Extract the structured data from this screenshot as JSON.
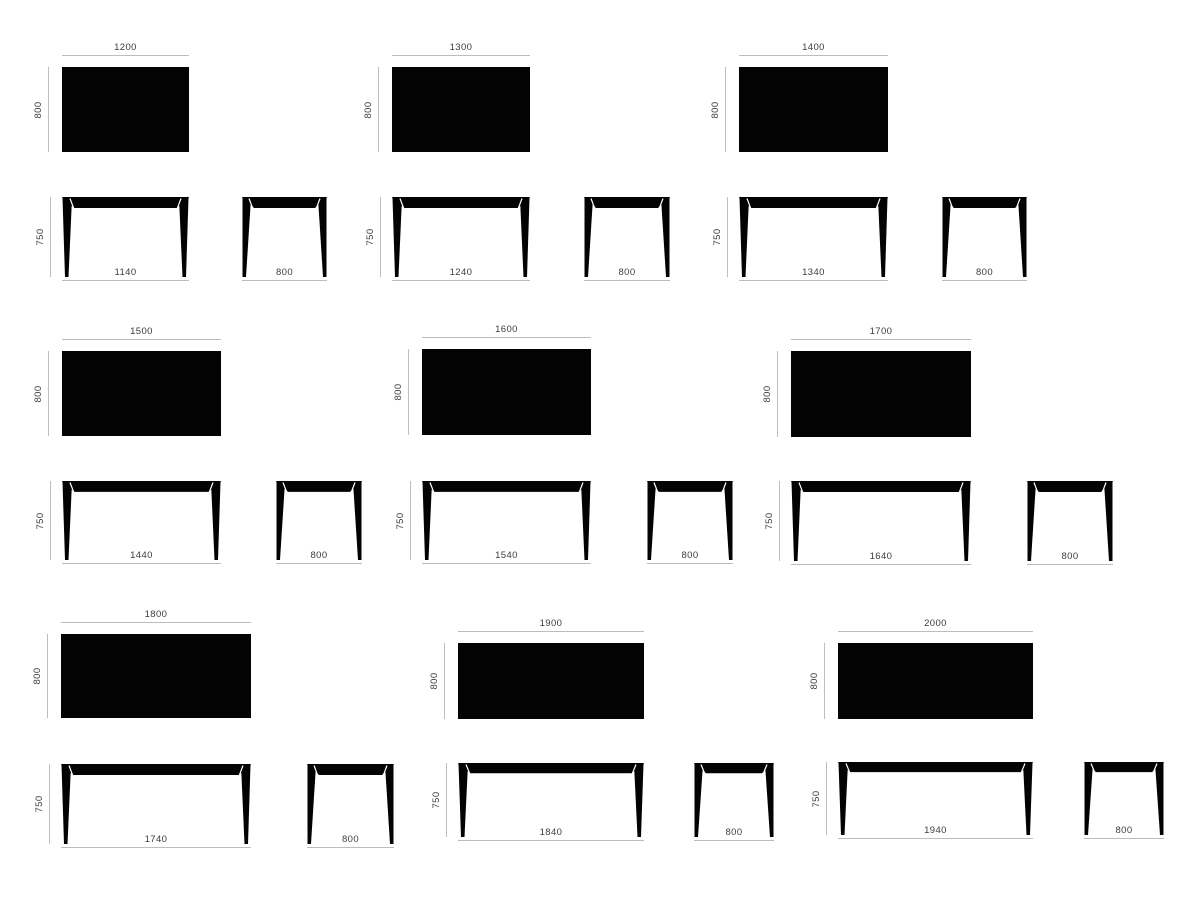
{
  "drawing": {
    "kind": "table-size-variants-technical-drawing",
    "colors": {
      "shape": "#030303",
      "dim_line": "#bdbdbd",
      "dim_text": "#3c3c3c",
      "background": "#ffffff"
    },
    "cells": [
      {
        "name": "1200",
        "top_width": "1200",
        "depth": "800",
        "height": "750",
        "feet_span": "1140",
        "side_span": "800"
      },
      {
        "name": "1300",
        "top_width": "1300",
        "depth": "800",
        "height": "750",
        "feet_span": "1240",
        "side_span": "800"
      },
      {
        "name": "1400",
        "top_width": "1400",
        "depth": "800",
        "height": "750",
        "feet_span": "1340",
        "side_span": "800"
      },
      {
        "name": "1500",
        "top_width": "1500",
        "depth": "800",
        "height": "750",
        "feet_span": "1440",
        "side_span": "800"
      },
      {
        "name": "1600",
        "top_width": "1600",
        "depth": "800",
        "height": "750",
        "feet_span": "1540",
        "side_span": "800"
      },
      {
        "name": "1700",
        "top_width": "1700",
        "depth": "800",
        "height": "750",
        "feet_span": "1640",
        "side_span": "800"
      },
      {
        "name": "1800",
        "top_width": "1800",
        "depth": "800",
        "height": "750",
        "feet_span": "1740",
        "side_span": "800"
      },
      {
        "name": "1900",
        "top_width": "1900",
        "depth": "800",
        "height": "750",
        "feet_span": "1840",
        "side_span": "800"
      },
      {
        "name": "2000",
        "top_width": "2000",
        "depth": "800",
        "height": "750",
        "feet_span": "1940",
        "side_span": "800"
      }
    ]
  }
}
